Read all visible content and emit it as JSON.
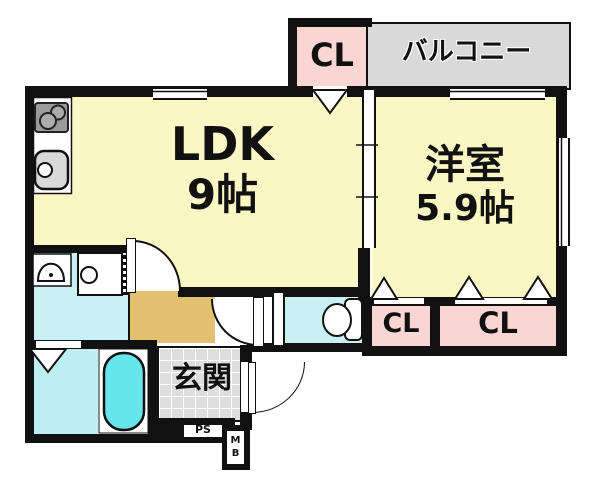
{
  "floorplan": {
    "rooms": {
      "ldk": {
        "name": "LDK",
        "size": "9帖"
      },
      "western_room": {
        "name": "洋室",
        "size": "5.9帖"
      },
      "balcony": {
        "label": "バルコニー"
      },
      "closet_top": {
        "label": "CL"
      },
      "closet_bottom_left": {
        "label": "CL"
      },
      "closet_bottom_right": {
        "label": "CL"
      },
      "entrance": {
        "label": "玄関"
      },
      "pipe_space": {
        "label": "PS"
      },
      "meter_box": {
        "label": "MB"
      }
    },
    "colors": {
      "wall": "#111111",
      "room_yellow": "#FBF7C5",
      "closet_pink": "#F9D6D3",
      "balcony_gray": "#D9D9D9",
      "entrance_tile_gray": "#DEDEDE",
      "hallway_tan": "#E2C06F",
      "water_area_cyan": "#C9F0F3",
      "bathtub_cyan": "#66E5EA",
      "stove_gray": "#9B9B9B",
      "sink_gray": "#D9D9D9"
    }
  }
}
